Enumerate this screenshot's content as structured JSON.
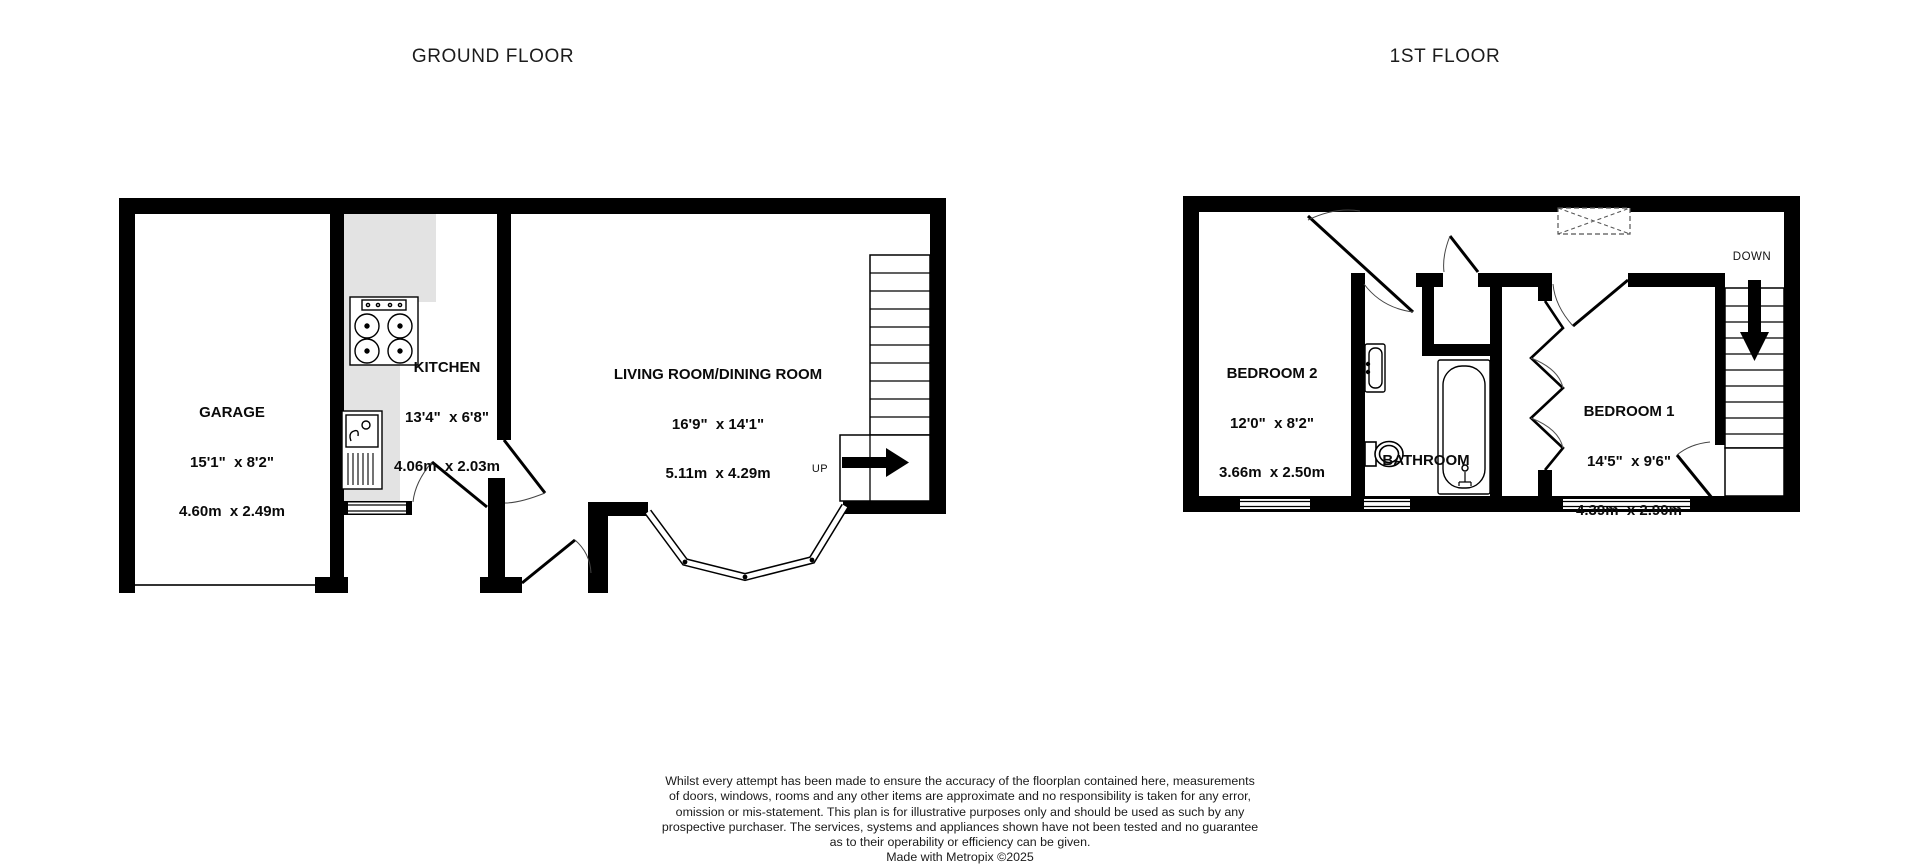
{
  "titles": {
    "ground": "GROUND FLOOR",
    "first": "1ST FLOOR"
  },
  "rooms": {
    "garage": {
      "name": "GARAGE",
      "imperial": "15'1\"  x 8'2\"",
      "metric": "4.60m  x 2.49m"
    },
    "kitchen": {
      "name": "KITCHEN",
      "imperial": "13'4\"  x 6'8\"",
      "metric": "4.06m  x 2.03m"
    },
    "living_room": {
      "name": "LIVING ROOM/DINING ROOM",
      "imperial": "16'9\"  x 14'1\"",
      "metric": "5.11m  x 4.29m"
    },
    "bedroom2": {
      "name": "BEDROOM 2",
      "imperial": "12'0\"  x 8'2\"",
      "metric": "3.66m  x 2.50m"
    },
    "bedroom1": {
      "name": "BEDROOM 1",
      "imperial": "14'5\"  x 9'6\"",
      "metric": "4.39m  x 2.90m"
    },
    "bathroom": {
      "name": "BATHROOM"
    }
  },
  "stairs": {
    "up": "UP",
    "down": "DOWN"
  },
  "disclaimer": {
    "lines": [
      "Whilst every attempt has been made to ensure the accuracy of the floorplan contained here, measurements",
      "of doors, windows, rooms and any other items are approximate and no responsibility is taken for any error,",
      "omission or mis-statement. This plan is for illustrative purposes only and should be used as such by any",
      "prospective purchaser. The services, systems and appliances shown have not been tested and no guarantee",
      "as to their operability or efficiency can be given.",
      "Made with Metropix ©2025"
    ]
  },
  "colors": {
    "wall": "#000000",
    "counter": "#e3e3e3",
    "text": "#1a1a1a"
  }
}
